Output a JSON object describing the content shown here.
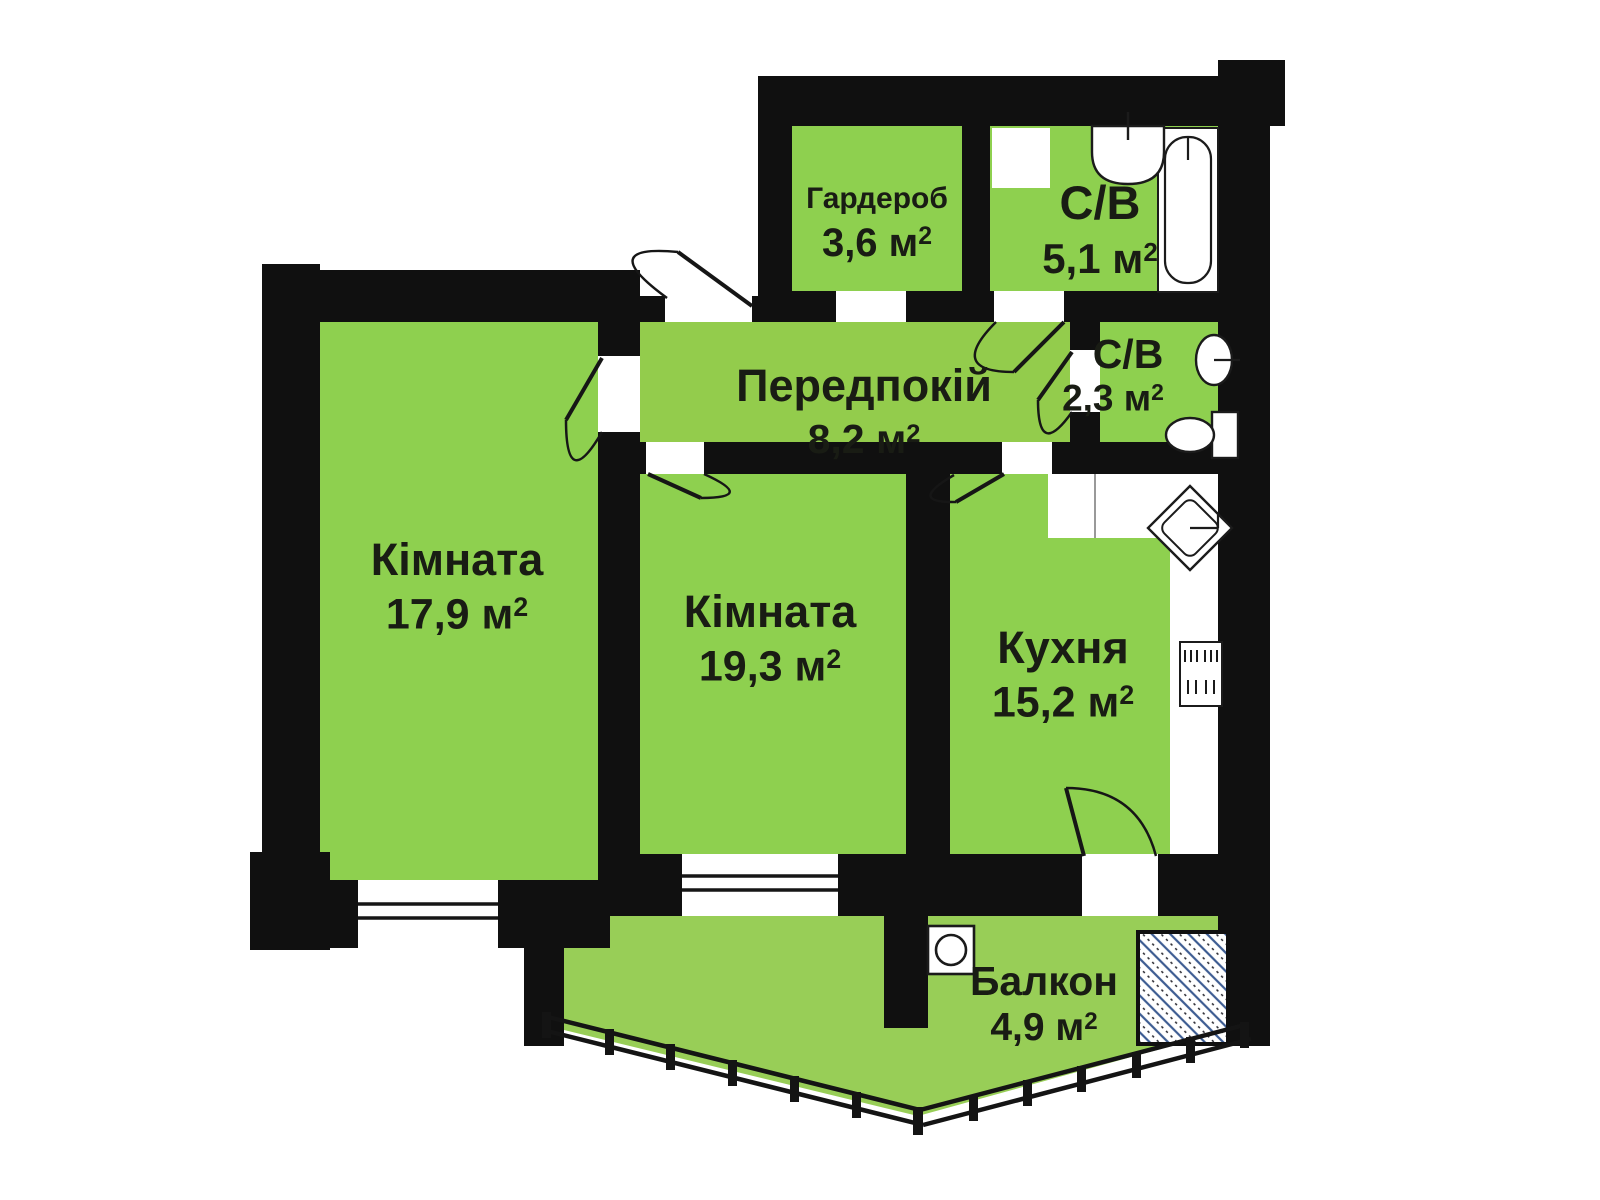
{
  "title": "Apartment floor plan (2-room with kitchen and balcony)",
  "language": "uk",
  "colors": {
    "room_green": "#8ed04f",
    "balcony_green": "#98ce57",
    "wall_black": "#101010",
    "hatch_blue": "#3d5c92",
    "background": "#ffffff",
    "text": "#191c14"
  },
  "rooms": [
    {
      "id": "wardrobe",
      "name": "Гардероб",
      "area": "3,6 м",
      "sup": "2"
    },
    {
      "id": "bath-large",
      "name": "С/В",
      "area": "5,1 м",
      "sup": "2"
    },
    {
      "id": "hallway",
      "name": "Передпокій",
      "area": "8,2 м",
      "sup": "2"
    },
    {
      "id": "bath-small",
      "name": "С/В",
      "area": "2,3 м",
      "sup": "2"
    },
    {
      "id": "room-1",
      "name": "Кімната",
      "area": "17,9 м",
      "sup": "2"
    },
    {
      "id": "room-2",
      "name": "Кімната",
      "area": "19,3 м",
      "sup": "2"
    },
    {
      "id": "kitchen",
      "name": "Кухня",
      "area": "15,2 м",
      "sup": "2"
    },
    {
      "id": "balcony",
      "name": "Балкон",
      "area": "4,9 м",
      "sup": "2"
    }
  ],
  "fixtures": [
    "bathtub-icon",
    "washbasin-icon",
    "washbasin-small-icon",
    "toilet-icon",
    "corner-sink-icon",
    "stove-icon",
    "washing-machine-icon",
    "shaft-hatch-icon",
    "balcony-railing",
    "door-swing-icons",
    "window-icons"
  ]
}
